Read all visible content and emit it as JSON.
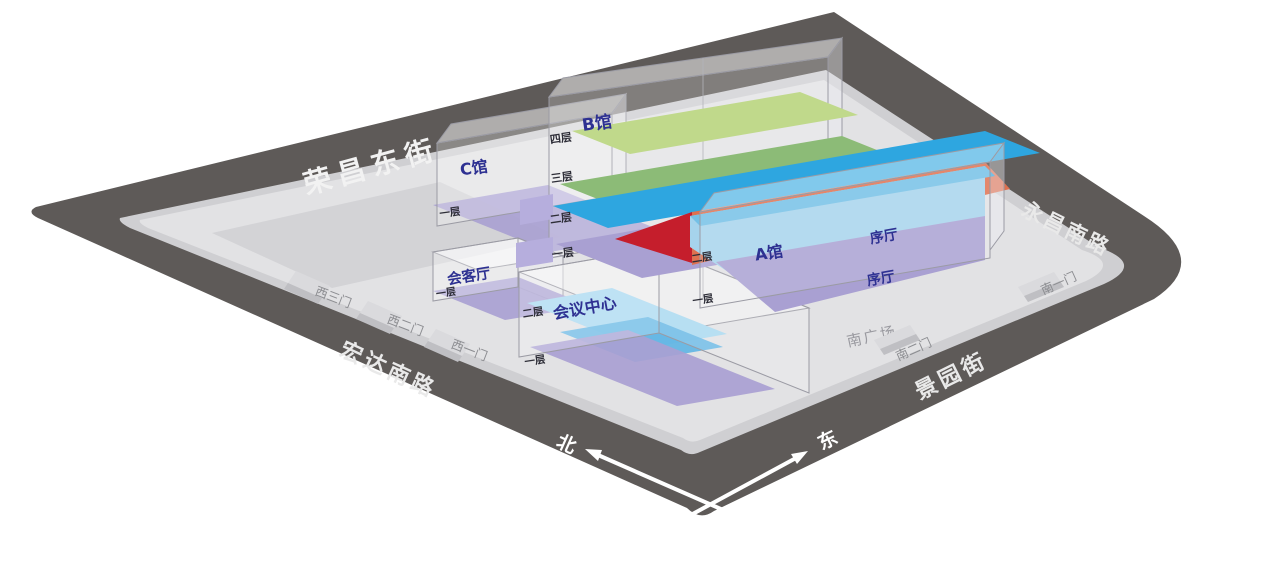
{
  "map": {
    "roads": {
      "top_left": "荣昌东街",
      "top_right": "永昌南路",
      "bottom_left": "宏达南路",
      "bottom_right": "景园街"
    },
    "gates": {
      "west_3": "西三门",
      "west_2": "西二门",
      "west_1": "西一门",
      "south_2": "南二门",
      "south_1": "南一门"
    },
    "compass": {
      "north": "北",
      "east": "东"
    },
    "plaza": "南广场",
    "halls": {
      "hall_b": {
        "name": "B馆",
        "floor_4": "四层",
        "floor_3": "三层",
        "floor_2": "二层",
        "floor_1": "一层"
      },
      "hall_c": {
        "name": "C馆",
        "floor_1": "一层"
      },
      "hall_a": {
        "name": "A馆",
        "floor_2": "二层",
        "floor_1": "一层",
        "lobby_upper": "序厅",
        "lobby_lower": "序厅"
      },
      "reception": {
        "name": "会客厅",
        "floor_1": "一层"
      },
      "conference": {
        "name": "会议中心",
        "floor_2": "二层",
        "floor_1": "一层"
      },
      "corridor": {
        "name": "AB馆二层连廊"
      }
    },
    "colors": {
      "road": "#5e5a58",
      "curb": "#cfcfd2",
      "platform": "#e2e2e4",
      "parking": "#cdcdd1",
      "floor4_green": "#c0d98b",
      "floor3_green": "#8cbb77",
      "floor2_blue": "#2ea6e0",
      "floor1_purple": "#a9a0d2",
      "corridor_orange": "#de7150",
      "accent_red": "#c51e2c",
      "hall_a_blue": "#a6d3ec",
      "conference_blue": "#a8d8f0",
      "label_navy": "#2e3192",
      "floor_label": "#2e2e38",
      "gate_gray": "#8c8d91",
      "plaza_gray": "#9a9aa0",
      "road_text": "#f2f2f2"
    }
  }
}
